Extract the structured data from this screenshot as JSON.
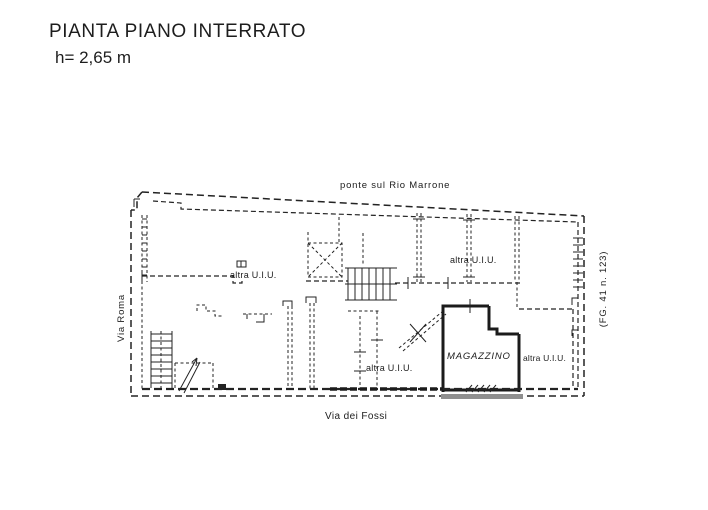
{
  "title": {
    "line1": "PIANTA PIANO INTERRATO",
    "line2": "h= 2,65 m"
  },
  "plan": {
    "bridge_label": "ponte sul Rio Marrone",
    "street_left": "Via Roma",
    "street_bottom": "Via dei Fossi",
    "cadastral_ref": "(FG. 41 n. 123)",
    "room_storage": "MAGAZZINO",
    "unit_labels": [
      "altra U.I.U.",
      "altra U.I.U.",
      "altra U.I.U.",
      "altra U.I.U."
    ],
    "colors": {
      "ink": "#232323",
      "paper": "#ffffff",
      "shadow_gray": "#8f8f8f"
    }
  }
}
